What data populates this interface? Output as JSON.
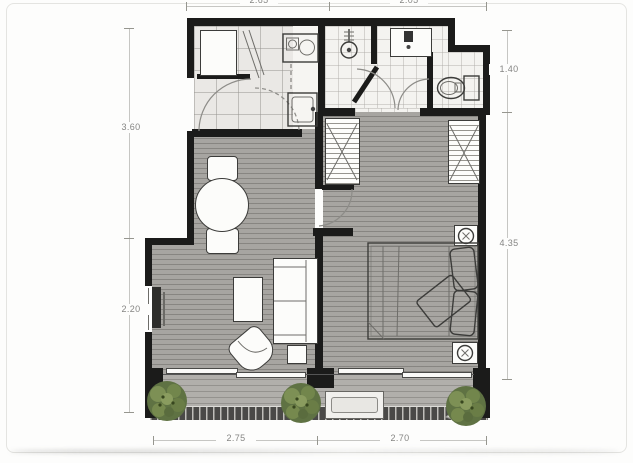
{
  "plan": {
    "type": "apartment-floor-plan",
    "dimension_labels": {
      "top_left_width": "2.65",
      "top_right_width": "2.05",
      "left_upper_height": "3.60",
      "left_lower_height": "2.20",
      "right_upper_height": "1.40",
      "right_lower_height": "4.35",
      "bottom_left_width": "2.75",
      "bottom_right_width": "2.70"
    },
    "colors": {
      "wall": "#1b1b1a",
      "wood_floor": "#a7a5a1",
      "balcony_floor": "#b1afab",
      "kitchen_tile": "#eae8e5",
      "bath_tile": "#f4f3f0",
      "furniture_fill": "#fcfcfa",
      "plant_green": "#5f7243",
      "railing": "#4a4947",
      "dimension_text": "#858583"
    },
    "icon_names": [
      "refrigerator",
      "stove",
      "kitchen-sink",
      "shower",
      "vanity-sink",
      "toilet",
      "wardrobe",
      "bed",
      "pillow",
      "dining-table",
      "dining-chair",
      "sofa",
      "coffee-table",
      "side-table",
      "lounge-chair",
      "tv-console",
      "window",
      "sliding-door",
      "air-conditioner",
      "plant",
      "ceiling-fan-symbol",
      "door-swing"
    ]
  }
}
